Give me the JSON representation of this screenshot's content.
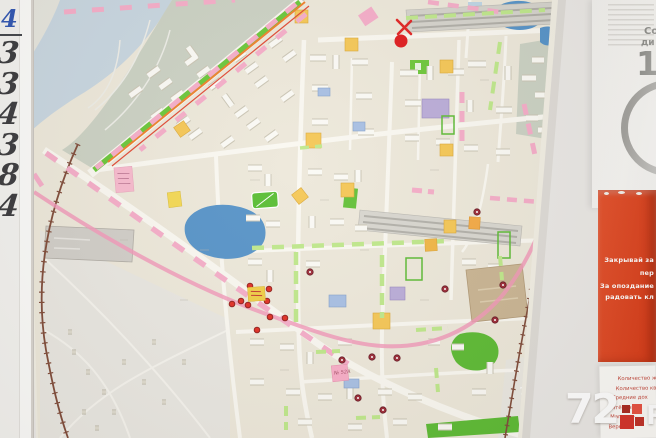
{
  "whiteboard": {
    "header_char": "4",
    "digits": [
      "3",
      "3",
      "4",
      "3",
      "8",
      "4"
    ]
  },
  "map": {
    "note_text": "№ 52А"
  },
  "right_panel": {
    "top_sheet": {
      "circle_line1": "Со",
      "circle_line2": "ди",
      "circle_number": "1"
    },
    "red_poster": {
      "bg_color": "#DC4423",
      "lines": [
        "Закрывай за",
        "пер",
        "За опоздание",
        "радовать кл"
      ]
    },
    "stats_sheet": {
      "text_color": "#C2463A",
      "lines": [
        "Количество ж",
        "Количество кв",
        "Средние дох",
        "Пятёрочка –",
        "Магнит –",
        "Верный –"
      ]
    }
  },
  "watermark": {
    "prefix": "72",
    "suffix": "RU",
    "square_colors": [
      "#AA2A21",
      "#E85242",
      "#D5342B",
      "#BF3127"
    ]
  },
  "colors": {
    "pond_blue": "#4D8EC6",
    "green_street": "#62C42F",
    "pink_route": "#F292B5",
    "pink_highlight": "#F5A9C6",
    "green_highlight": "#BCE785",
    "railway_brown": "#7A4330"
  }
}
